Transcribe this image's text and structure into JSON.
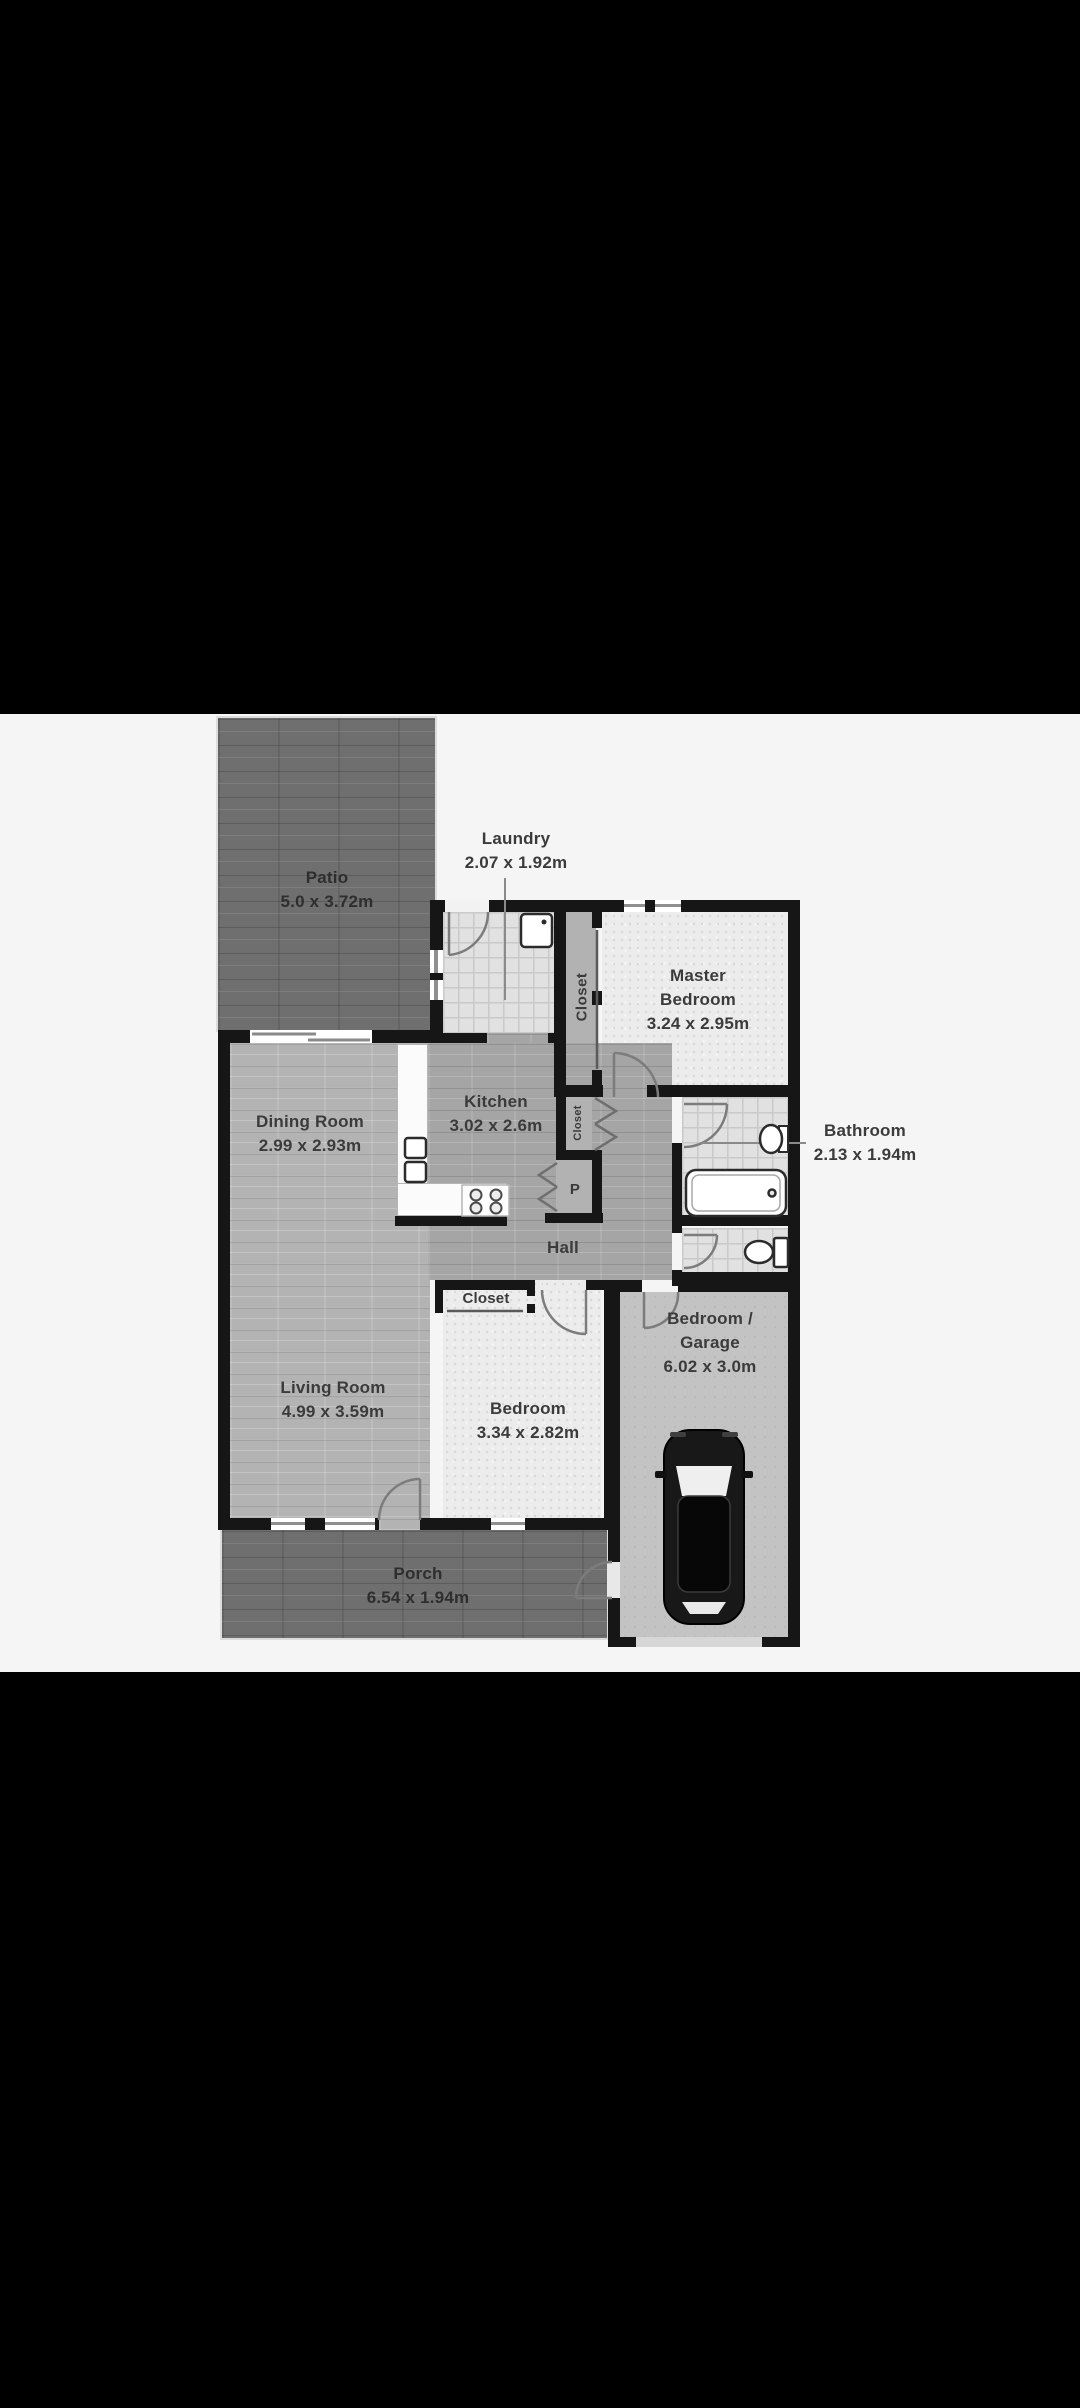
{
  "image": {
    "kind": "floor-plan-photo",
    "letterbox_color": "#000000",
    "canvas_color": "#f5f5f5",
    "wall_color": "#161616",
    "label_color": "#3b3b3b",
    "dark_wood_color": "#6f6f6f",
    "light_wood_color": "#b3b3b3",
    "tile_color": "#e1e1e1",
    "bedroom_floor_color": "#ececec",
    "garage_floor_color": "#c3c3c3",
    "closet_gray_color": "#b2b2b2"
  },
  "rooms": {
    "patio": {
      "name": "Patio",
      "dims": "5.0 x 3.72m"
    },
    "laundry": {
      "name": "Laundry",
      "dims": "2.07 x 1.92m"
    },
    "master_bedroom": {
      "name_line1": "Master",
      "name_line2": "Bedroom",
      "dims": "3.24 x 2.95m"
    },
    "master_closet": {
      "name": "Closet"
    },
    "dining_room": {
      "name": "Dining Room",
      "dims": "2.99 x 2.93m"
    },
    "kitchen": {
      "name": "Kitchen",
      "dims": "3.02 x 2.6m"
    },
    "hall_closet": {
      "name": "Closet"
    },
    "pantry": {
      "abbr": "P"
    },
    "bathroom": {
      "name": "Bathroom",
      "dims": "2.13 x 1.94m"
    },
    "hall": {
      "name": "Hall"
    },
    "bedroom": {
      "name": "Bedroom",
      "dims": "3.34 x 2.82m"
    },
    "bedroom_closet": {
      "name": "Closet"
    },
    "garage": {
      "name_line1": "Bedroom /",
      "name_line2": "Garage",
      "dims": "6.02 x 3.0m"
    },
    "porch": {
      "name": "Porch",
      "dims": "6.54 x 1.94m"
    }
  },
  "fixtures": [
    "washing-machine",
    "kitchen-sink",
    "stove",
    "pantry-bifold-door",
    "closet-bifold-door",
    "bathtub",
    "bathroom-sink",
    "toilet",
    "car"
  ]
}
